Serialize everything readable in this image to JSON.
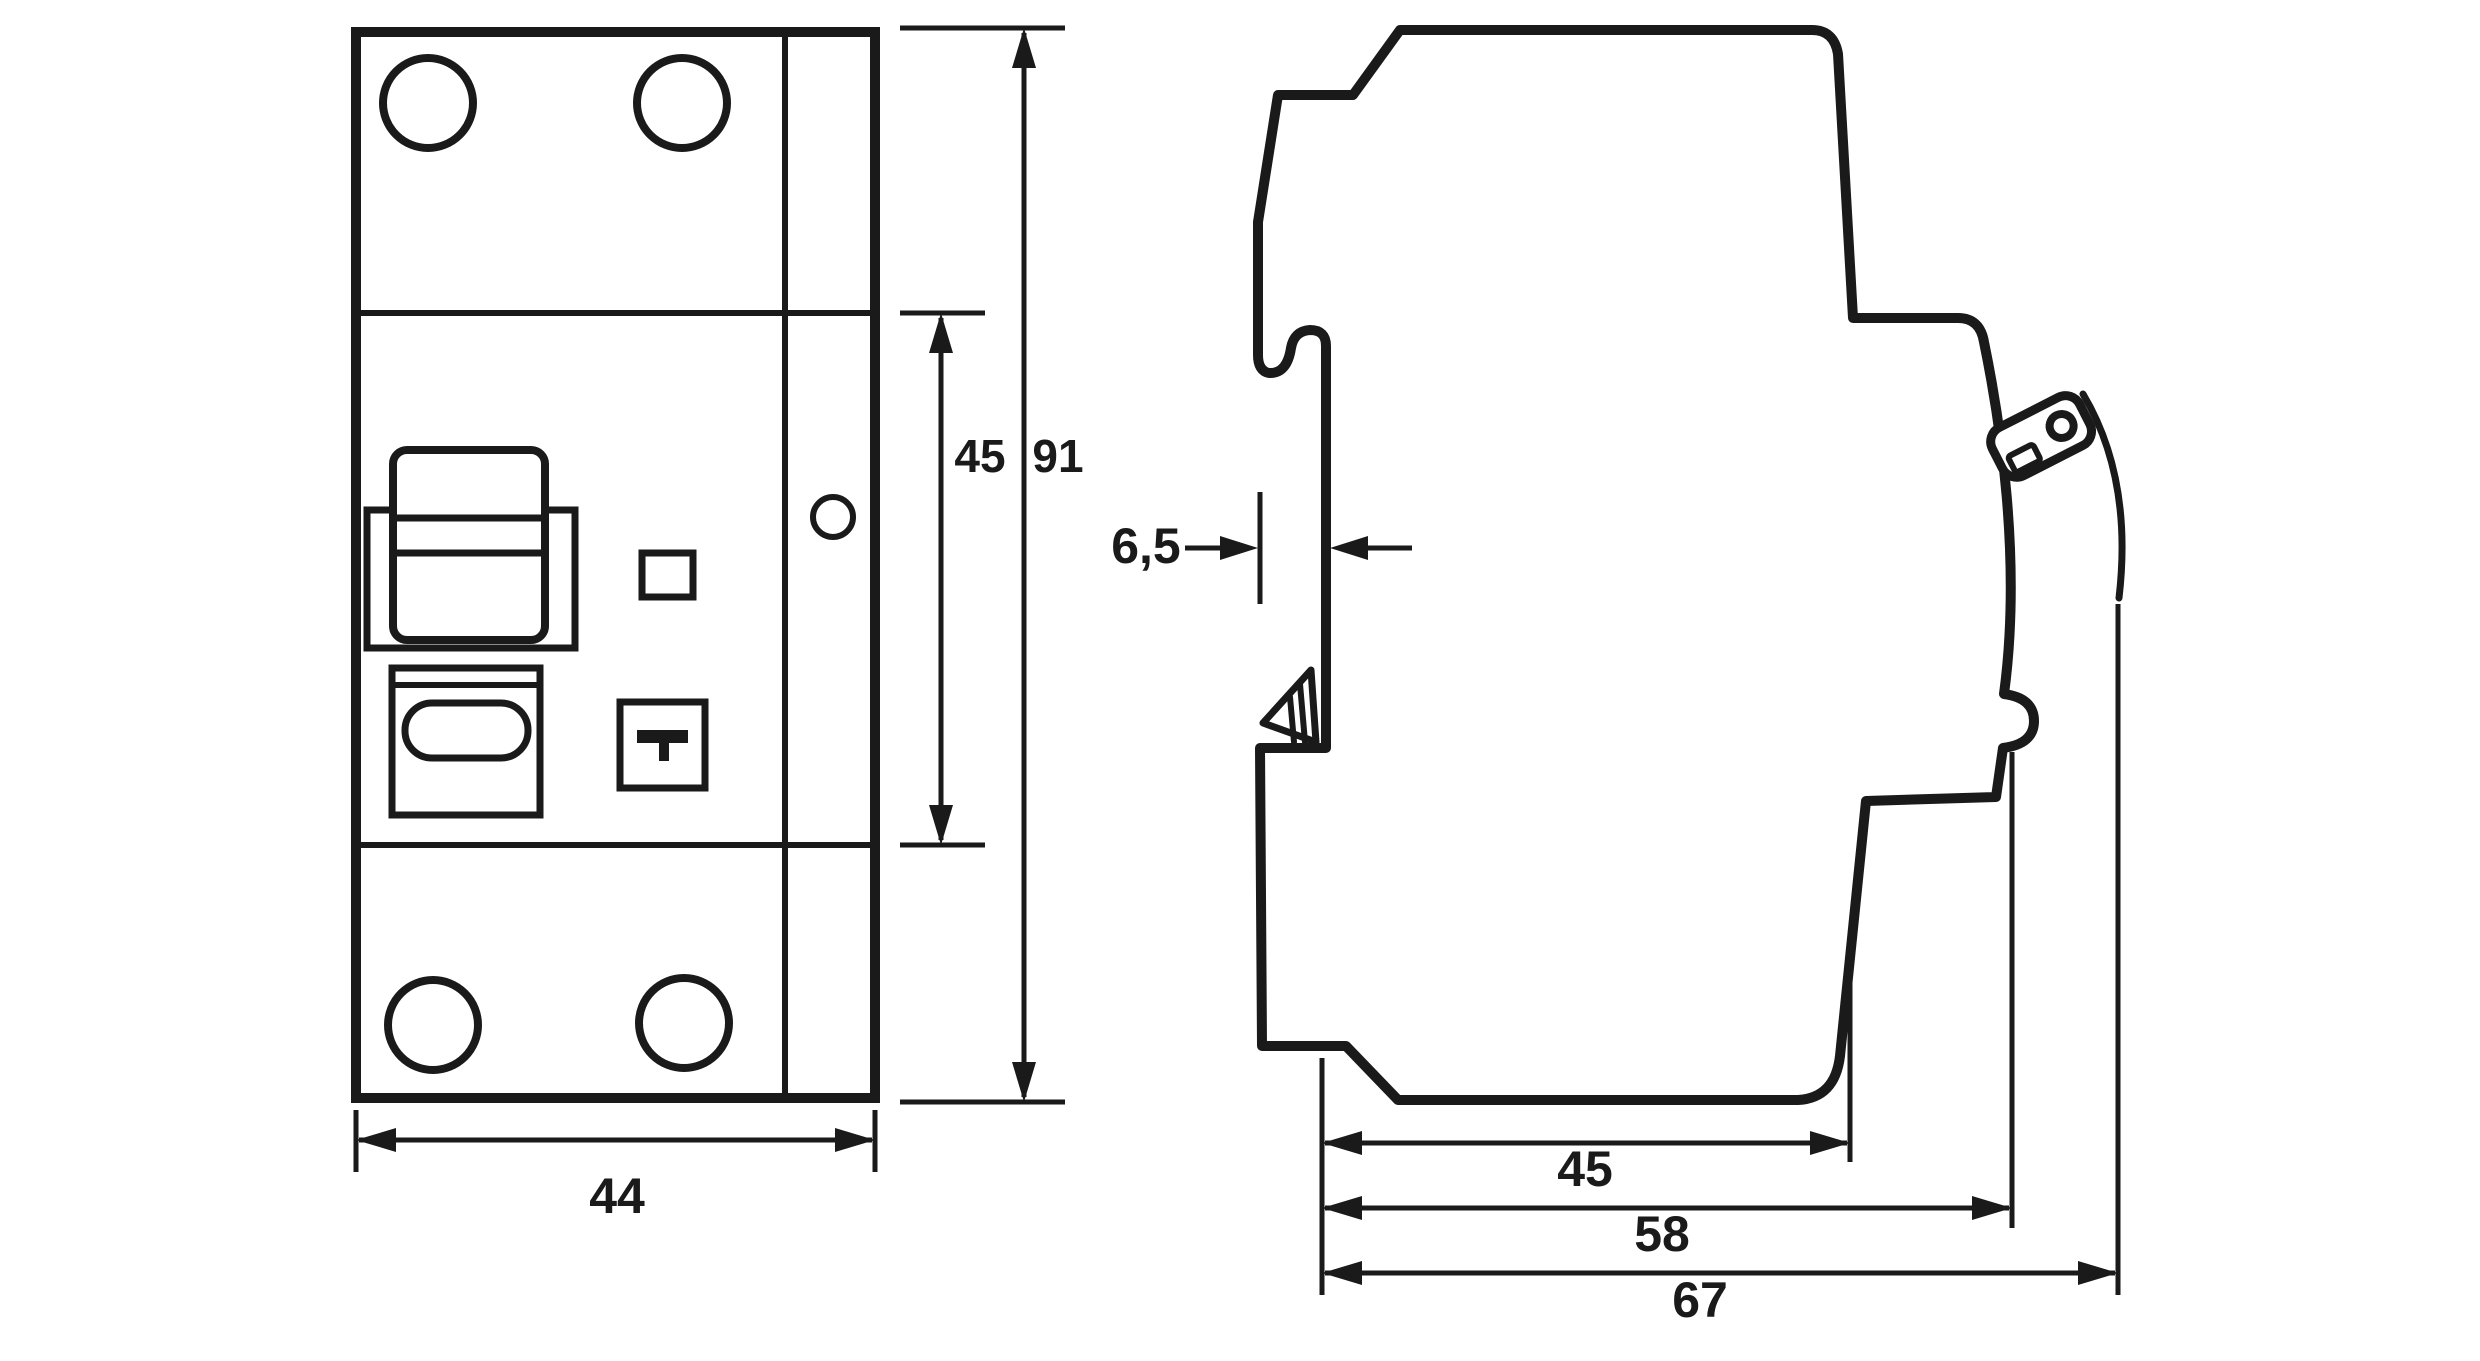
{
  "diagram": {
    "background_color": "#ffffff",
    "line_color": "#1a1a1a",
    "front_view": {
      "width_mm": "44",
      "module_height_mm": "45",
      "total_height_mm": "91"
    },
    "side_view": {
      "rail_recess_depth_mm": "6,5",
      "depth_to_body_front_mm": "45",
      "depth_to_mid_front_mm": "58",
      "depth_total_mm": "67"
    }
  }
}
